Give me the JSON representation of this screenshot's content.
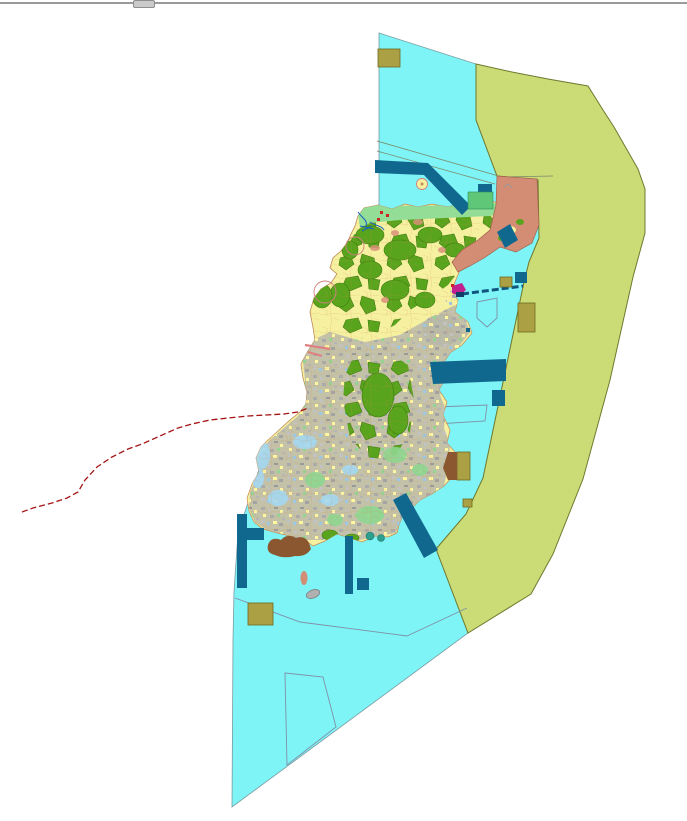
{
  "window": {
    "kind": "gis-map-viewport",
    "has_top_splitter": true
  },
  "map": {
    "description": "land-use zoning map of an island with coastal water, offshore buffer band, parcel mosaic landmass, marine structures and a dashed route line",
    "features": [
      {
        "name": "coastal-water-polygon",
        "color_key": "water_cyan"
      },
      {
        "name": "offshore-buffer-band",
        "color_key": "buffer_olive"
      },
      {
        "name": "island-landmass",
        "color_key": "island_yellow"
      },
      {
        "name": "forest-parcel-clusters",
        "color_key": "forest_green"
      },
      {
        "name": "urban-parcel-mosaic",
        "color_key": "urban_gray"
      },
      {
        "name": "north-shore-strip",
        "color_key": "shore_green"
      },
      {
        "name": "northeast-salmon-zone",
        "color_key": "salmon"
      },
      {
        "name": "navy-marine-structures",
        "color_key": "navy_blue"
      },
      {
        "name": "khaki-blocks",
        "color_key": "khaki"
      },
      {
        "name": "brown-blocks",
        "color_key": "brown"
      },
      {
        "name": "red-dashed-route",
        "color_key": "route_red"
      },
      {
        "name": "pale-blue-coast-patches",
        "color_key": "pale_blue"
      },
      {
        "name": "white-outlined-parcels",
        "color_key": "outline_gray"
      }
    ]
  },
  "palette": {
    "background": "#FFFFFF",
    "divider_gray": "#9A9A9A",
    "thumb_gray": "#CACACA",
    "water_cyan": "#7EF4F6",
    "water_border": "#7A9AA0",
    "buffer_olive": "#CBDC77",
    "buffer_olive_border": "#6E7A2E",
    "island_yellow": "#F6F1A0",
    "parcel_border_orange": "#D08B4E",
    "forest_green": "#58A41C",
    "shore_green": "#93DD96",
    "bright_green": "#5FC878",
    "urban_gray": "#B7B7AA",
    "salmon": "#D28D74",
    "salmon_border": "#A06048",
    "navy_blue": "#11688F",
    "khaki": "#ACA044",
    "khaki_border": "#6F6A20",
    "brown": "#8A5730",
    "route_red": "#A51515",
    "pale_blue": "#A5D9F2",
    "river_blue": "#1560C8",
    "magenta": "#C02090",
    "outline_gray": "#8090A8",
    "cable_blue": "#0F5580",
    "red_dot": "#CC2222"
  }
}
